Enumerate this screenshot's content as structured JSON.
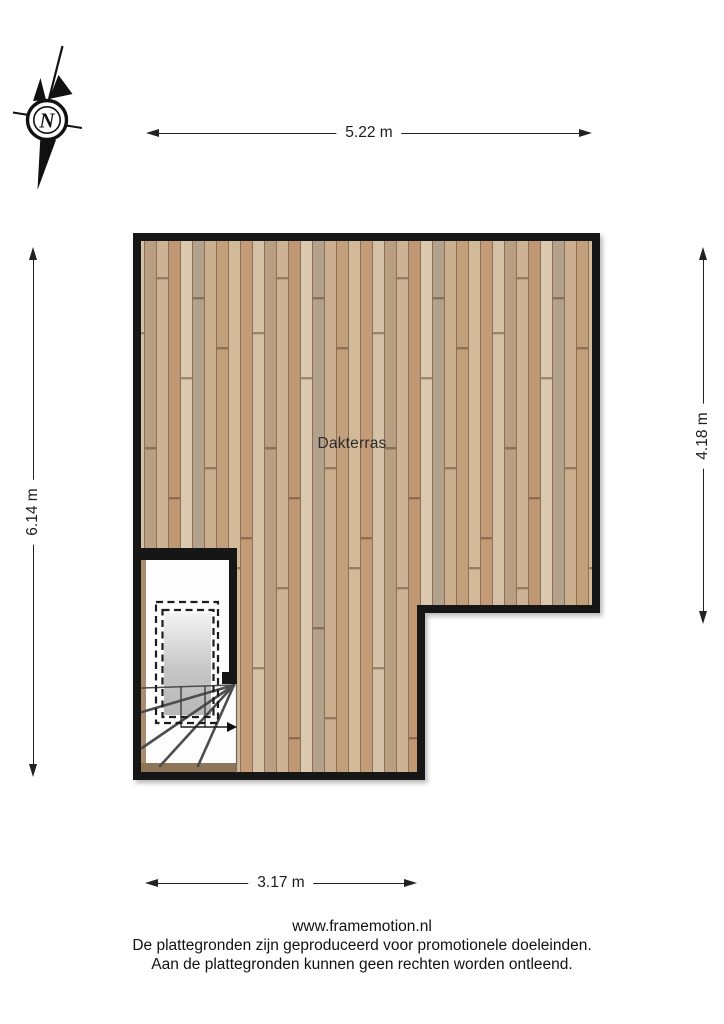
{
  "compass": {
    "north_label": "N"
  },
  "dimensions": {
    "top": "5.22 m",
    "left": "6.14 m",
    "right": "4.18 m",
    "bottom": "3.17 m"
  },
  "floorplan": {
    "room_label": "Dakterras"
  },
  "footer": {
    "website": "www.framemotion.nl",
    "disclaimer_line1": "De plattegronden zijn geproduceerd voor promotionele doeleinden.",
    "disclaimer_line2": "Aan de plattegronden kunnen geen rechten worden ontleend."
  },
  "colors": {
    "wall": "#171717",
    "deck_wood_base": "#c8ab8c",
    "stairwell_floor": "#fdfdfd",
    "roof_hatch_gray": "#bdbdbd",
    "dimension_line": "#222222"
  },
  "icons": {
    "compass": "compass-rose-north-icon",
    "stairs": "staircase-symbol",
    "direction_arrow": "stair-direction-arrow-icon"
  }
}
